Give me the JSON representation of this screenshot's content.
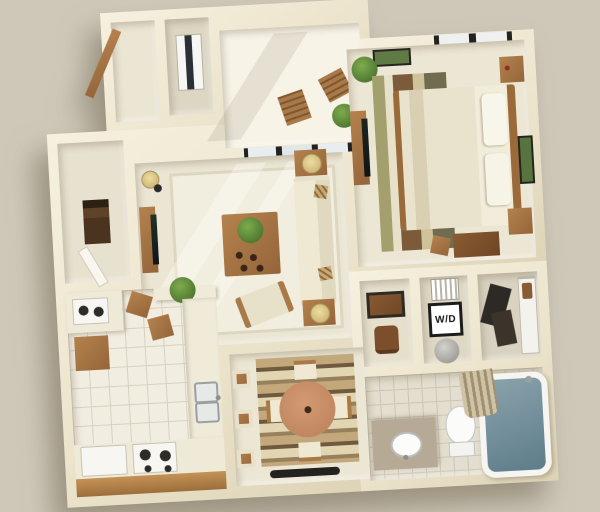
{
  "scene": {
    "type": "3d-isometric-floor-plan-render",
    "description": "Top-down 3D rendering of a one-bedroom apartment floor plan"
  },
  "labels": {
    "washer_dryer": "W/D"
  },
  "colors": {
    "background": "#cfc8b9",
    "wall": "#f2ecd9",
    "wall_shade": "#ddd3b6",
    "carpet": "#ebe6d4",
    "balcony_floor": "#f7f3e7",
    "kitchen_tile": "#f2ede1",
    "bath_tile": "#e3decf",
    "wood": "#ab7a45",
    "wood_dark": "#8a5c30",
    "cream_fabric": "#efe8d2",
    "terracotta_table": "#c68e69",
    "plant_green": "#4e7d33",
    "tub_water": "#6f8d9a",
    "appliance_white": "#f7f6f2",
    "dark_item": "#23221f",
    "rug_tan": "#b89c72"
  },
  "rooms": [
    {
      "name": "entry",
      "items": [
        "entry-door",
        "entry-closet"
      ]
    },
    {
      "name": "utility-closet",
      "items": [
        "water-heater"
      ]
    },
    {
      "name": "balcony",
      "items": [
        "patio-chair",
        "patio-chair",
        "potted-plant",
        "sliding-glass-door"
      ]
    },
    {
      "name": "bedroom",
      "items": [
        "queen-bed",
        "pillows",
        "nightstand",
        "nightstand",
        "dresser-with-tv",
        "striped-area-rug",
        "desk",
        "desk-chair",
        "framed-art",
        "framed-art",
        "window",
        "potted-plant"
      ]
    },
    {
      "name": "living-room",
      "items": [
        "sofa",
        "throw-pillows",
        "coffee-table",
        "potted-plant",
        "armchair",
        "end-table-with-lamp",
        "end-table-with-lamp",
        "tv-console",
        "floor-lamp",
        "bookshelf",
        "area-rug"
      ]
    },
    {
      "name": "kitchen",
      "items": [
        "refrigerator",
        "range-stove",
        "double-sink",
        "upper-cabinet",
        "microwave-cart",
        "breakfast-bar",
        "bar-stool",
        "bar-stool",
        "potted-plant",
        "tile-floor"
      ]
    },
    {
      "name": "dining-area",
      "items": [
        "round-dining-table",
        "dining-chair",
        "dining-chair",
        "dining-chair",
        "dining-chair",
        "bar-stool",
        "bar-stool",
        "bar-stool",
        "striped-rug",
        "floor-mat"
      ]
    },
    {
      "name": "hallway-nook",
      "items": [
        "desk",
        "office-chair"
      ]
    },
    {
      "name": "laundry-closet",
      "items": [
        "stacked-washer-dryer",
        "laundry-basket",
        "drying-rack"
      ]
    },
    {
      "name": "walk-in-closet",
      "items": [
        "hanging-clothes",
        "shelving-unit"
      ]
    },
    {
      "name": "bathroom",
      "items": [
        "vanity-sink",
        "toilet",
        "bathtub",
        "shower-curtain",
        "tile-floor"
      ]
    }
  ]
}
